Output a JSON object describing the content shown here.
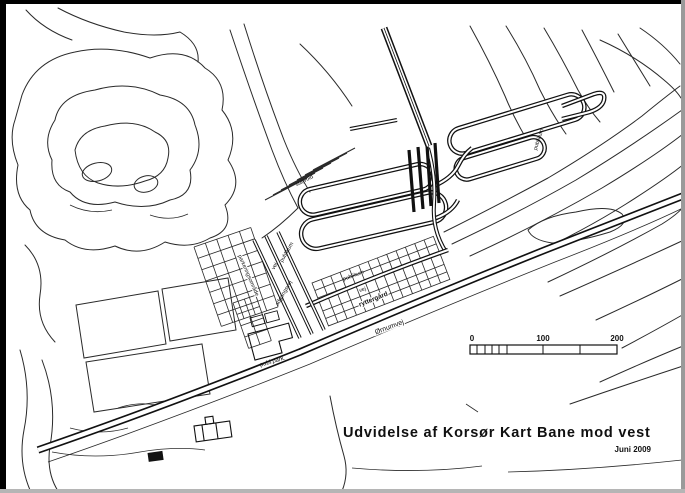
{
  "map": {
    "title": "Udvidelse af Korsør Kart Bane mod vest",
    "date": "Juni 2009",
    "scale_bar": {
      "tick_0": "0",
      "tick_100": "100",
      "tick_200": "200"
    },
    "labels": {
      "publikum_nw": "publikum",
      "vej_nw": "vej",
      "adgangsvej": "adgangsvej",
      "parkering": "parkeringsområde",
      "stoejvold": "støjvold",
      "publikum_mid": "publikum",
      "vej_mid": "vej",
      "ryttergaard": "ryttergård",
      "oernumvej": "Ørnumvej",
      "publ_park": "publ.park.",
      "publikum_east": "publikum"
    },
    "colors": {
      "ink": "#2a2a2a",
      "paper": "#ffffff",
      "frame": "#000000"
    }
  }
}
